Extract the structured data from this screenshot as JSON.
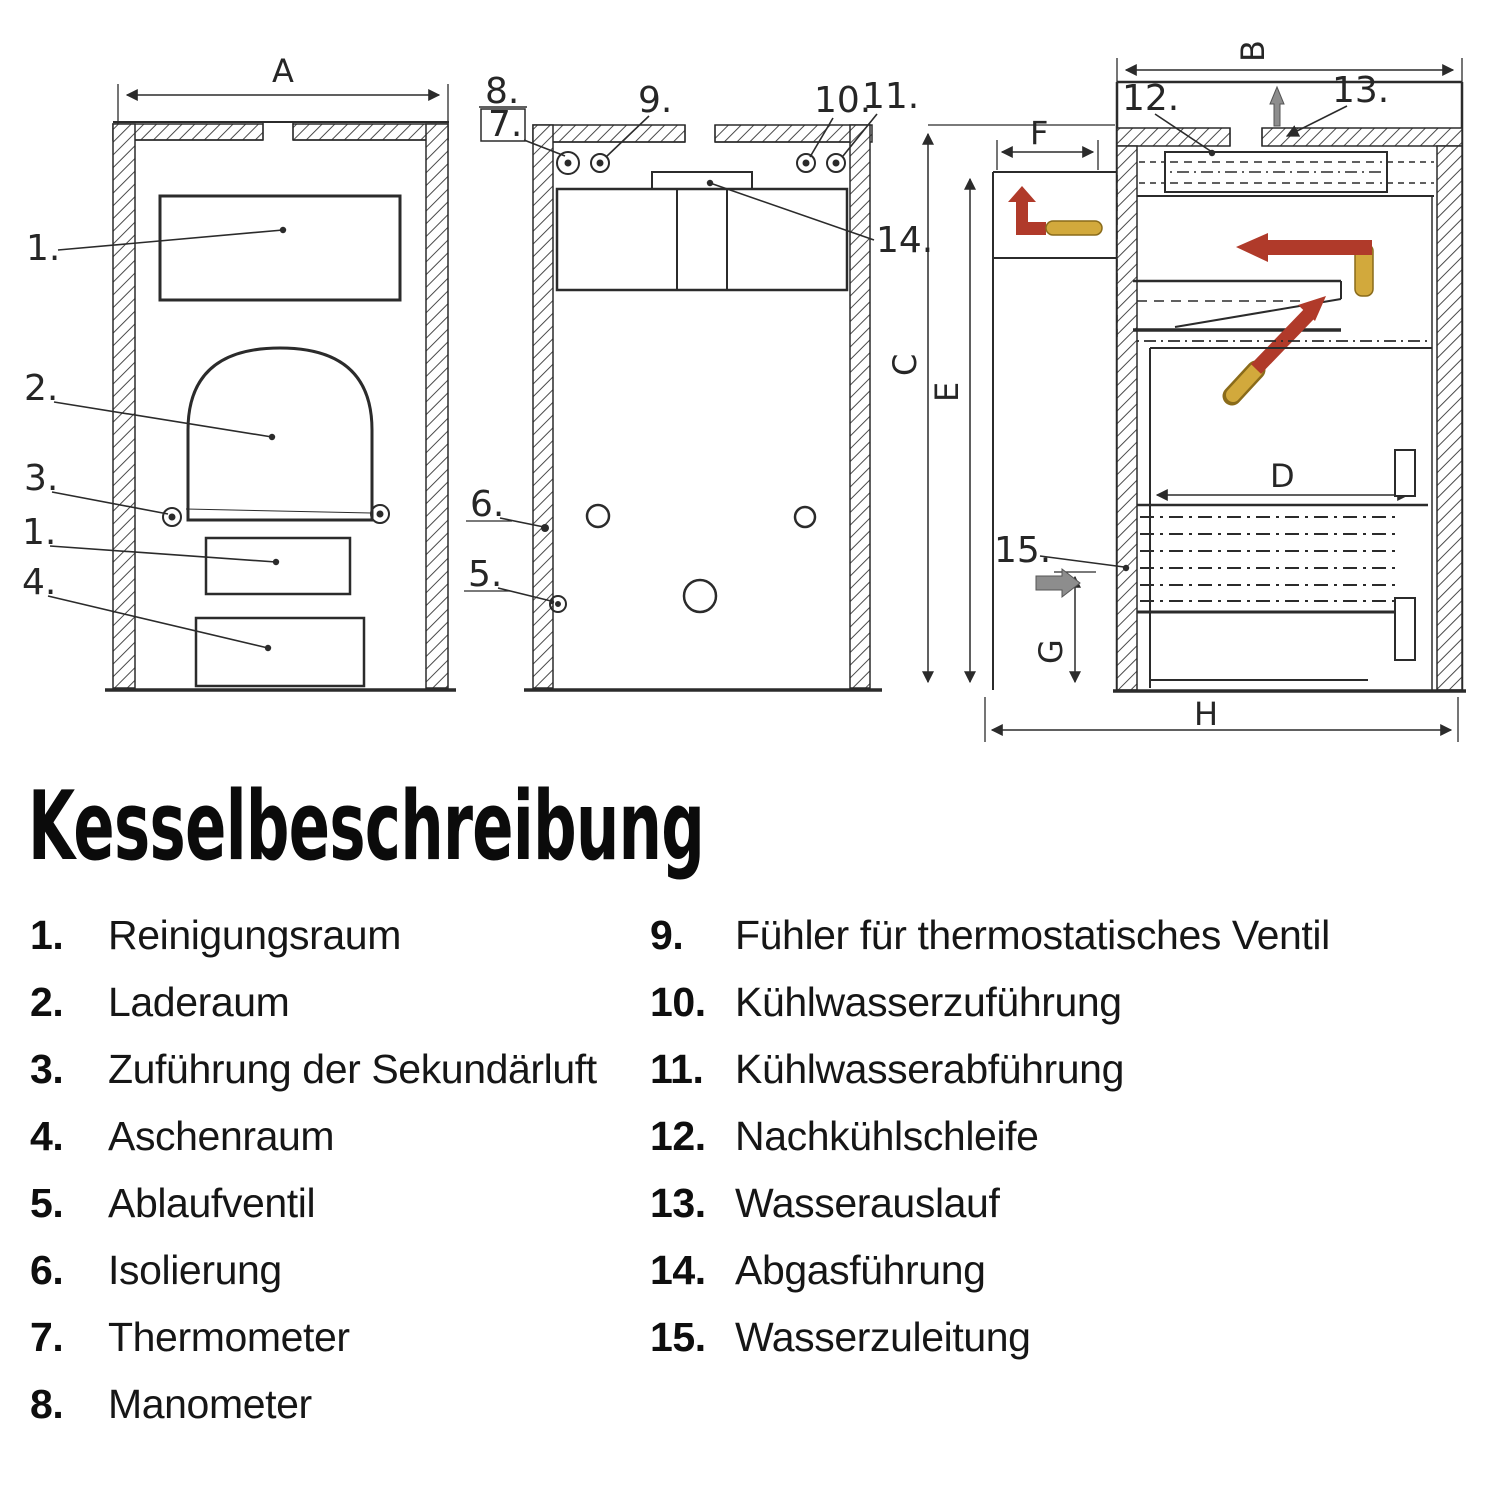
{
  "legend": {
    "title": "Kesselbeschreibung",
    "left": [
      {
        "num": "1.",
        "label": "Reinigungsraum"
      },
      {
        "num": "2.",
        "label": "Laderaum"
      },
      {
        "num": "3.",
        "label": "Zuführung der Sekundärluft"
      },
      {
        "num": "4.",
        "label": "Aschenraum"
      },
      {
        "num": "5.",
        "label": "Ablaufventil"
      },
      {
        "num": "6.",
        "label": "Isolierung"
      },
      {
        "num": "7.",
        "label": "Thermometer"
      },
      {
        "num": "8.",
        "label": "Manometer"
      }
    ],
    "right": [
      {
        "num": "9.",
        "label": "Fühler für thermostatisches Ventil"
      },
      {
        "num": "10.",
        "label": "Kühlwasserzuführung"
      },
      {
        "num": "11.",
        "label": "Kühlwasserabführung"
      },
      {
        "num": "12.",
        "label": "Nachkühlschleife"
      },
      {
        "num": "13.",
        "label": "Wasserauslauf"
      },
      {
        "num": "14.",
        "label": "Abgasführung"
      },
      {
        "num": "15.",
        "label": "Wasserzuleitung"
      }
    ]
  },
  "diagram": {
    "dims": {
      "a": "A",
      "b": "B",
      "c": "C",
      "d": "D",
      "e": "E",
      "f": "F",
      "g": "G",
      "h": "H"
    },
    "callouts": {
      "c1": "1.",
      "c2": "2.",
      "c3": "3.",
      "c4": "4.",
      "c5": "5.",
      "c6": "6.",
      "c7": "7.",
      "c8": "8.",
      "c9": "9.",
      "c10": "10.",
      "c11": "11.",
      "c12": "12.",
      "c13": "13.",
      "c14": "14.",
      "c15": "15."
    }
  },
  "colors": {
    "ink": "#2b2b2b",
    "red": "#b03a2a",
    "yellow": "#d2a93c",
    "gray": "#8d8d8d",
    "paper": "#ffffff"
  }
}
